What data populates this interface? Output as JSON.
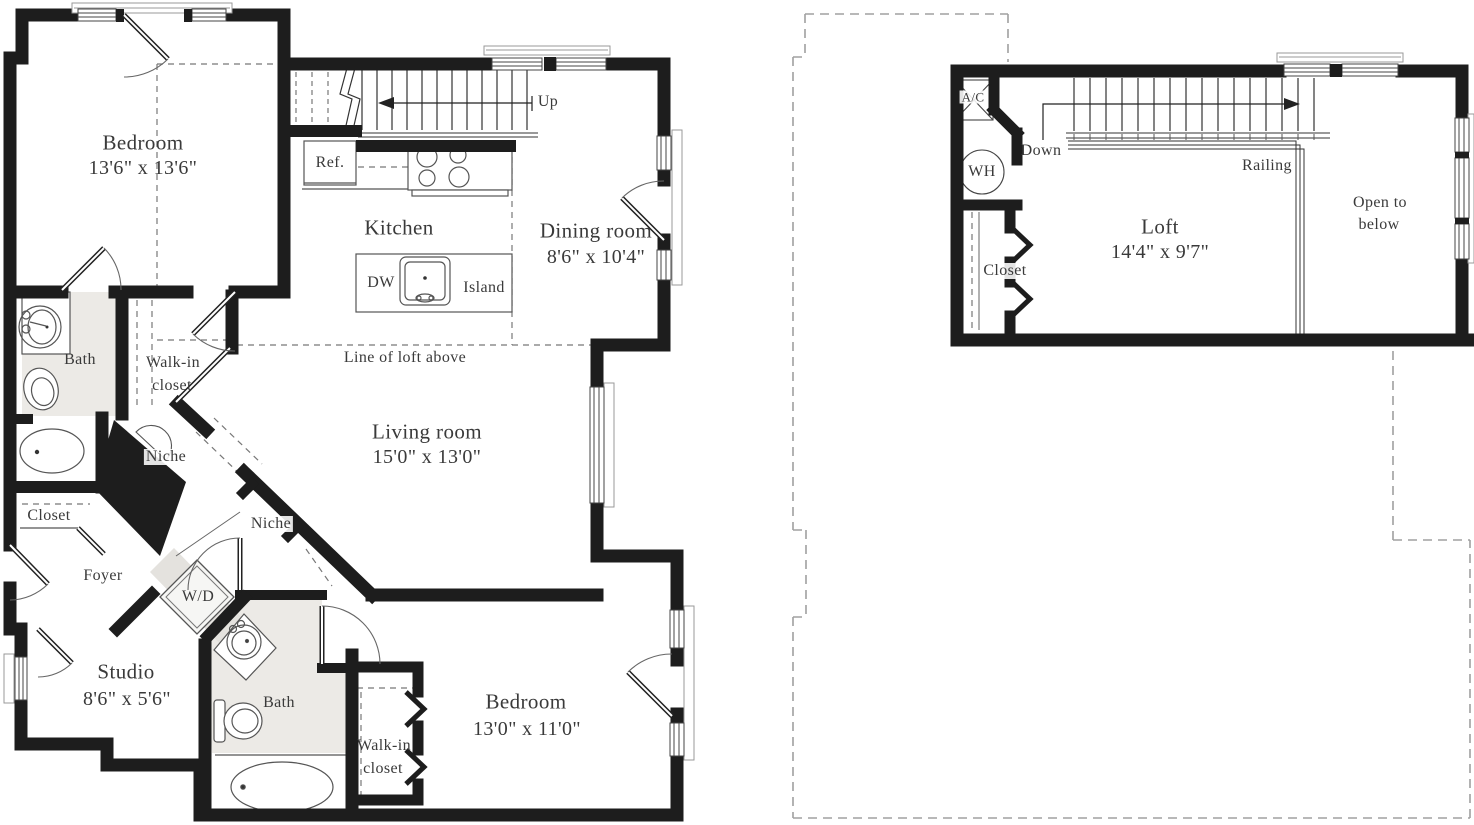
{
  "plan": {
    "main_level": {
      "bedroom1": {
        "name": "Bedroom",
        "dims": "13'6\" x 13'6\""
      },
      "stairs": {
        "direction_label": "Up"
      },
      "kitchen": {
        "name": "Kitchen",
        "fridge": "Ref.",
        "dishwasher": "DW",
        "island": "Island"
      },
      "dining_room": {
        "name": "Dining room",
        "dims": "8'6\" x 10'4\""
      },
      "living_room": {
        "name": "Living room",
        "dims": "15'0\" x 13'0\""
      },
      "loft_line_note": "Line of loft above",
      "bath1": {
        "name": "Bath"
      },
      "walk_in_closet1": {
        "line1": "Walk-in",
        "line2": "closet"
      },
      "niche1": {
        "label": "Niche"
      },
      "niche2": {
        "label": "Niche"
      },
      "closet": {
        "label": "Closet"
      },
      "foyer": {
        "label": "Foyer"
      },
      "washer_dryer": {
        "label": "W/D"
      },
      "studio": {
        "name": "Studio",
        "dims": "8'6\" x 5'6\""
      },
      "bath2": {
        "name": "Bath"
      },
      "walk_in_closet2": {
        "line1": "Walk-in",
        "line2": "closet"
      },
      "bedroom2": {
        "name": "Bedroom",
        "dims": "13'0\" x 11'0\""
      }
    },
    "loft_level": {
      "loft": {
        "name": "Loft",
        "dims": "14'4\" x 9'7\""
      },
      "stairs": {
        "direction_label": "Down"
      },
      "railing": {
        "label": "Railing"
      },
      "ac_unit": {
        "label": "A/C"
      },
      "water_heater": {
        "label": "WH"
      },
      "closet": {
        "label": "Closet"
      },
      "open_to_below": {
        "line1": "Open to",
        "line2": "below"
      }
    },
    "colors": {
      "walls": "#1d1d1d",
      "bath_shading": "#eceae6",
      "dashed_outline": "#a0a0a0",
      "text": "#3a3a3a"
    }
  }
}
